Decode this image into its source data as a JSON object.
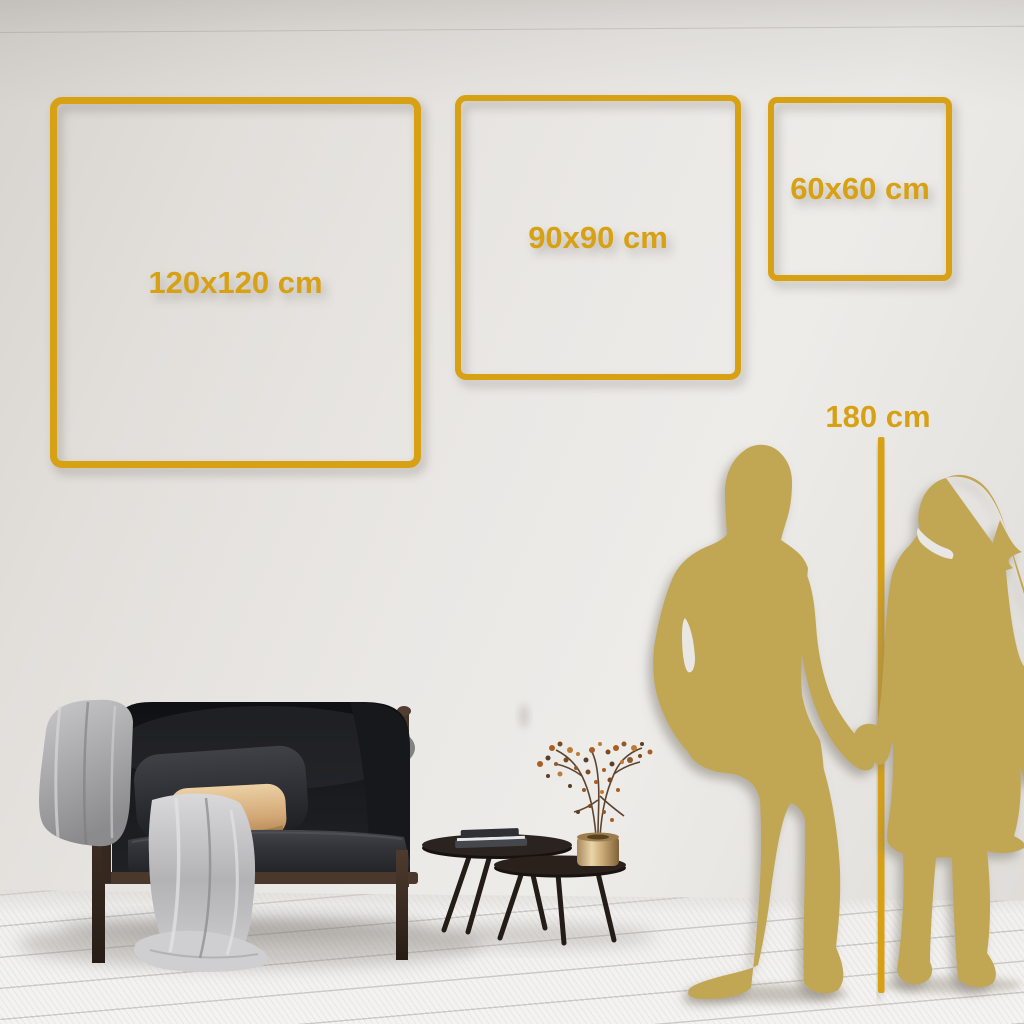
{
  "size_guide": {
    "labels": {
      "frame_large": "120x120 cm",
      "frame_medium": "90x90 cm",
      "frame_small": "60x60 cm",
      "height_reference": "180 cm"
    },
    "colors": {
      "accent_gold": "#d7a113",
      "silhouette_gold": "#c1a652",
      "wall": "#e7e4e0",
      "floor": "#f2f1ef",
      "sofa_dark": "#141518",
      "pillow_tan": "#dcb486",
      "blanket_gray": "#b5b5b7",
      "vase_brass": "#c8a877",
      "wood_frame": "#423228"
    },
    "icons": [
      "frame-outline-large",
      "frame-outline-medium",
      "frame-outline-small",
      "height-reference-line",
      "man-silhouette",
      "woman-silhouette",
      "sofa-illustration",
      "blanket-illustration",
      "coffee-tables-illustration",
      "vase-plant-illustration"
    ]
  }
}
